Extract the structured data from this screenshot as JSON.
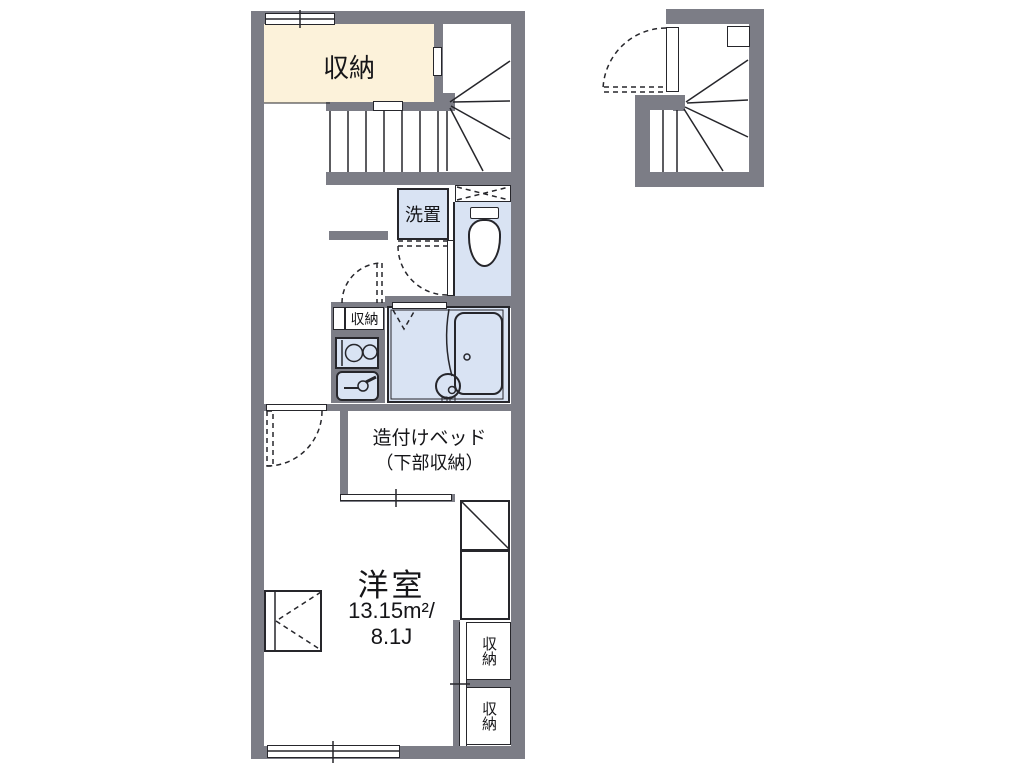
{
  "plan": {
    "labels": {
      "storage_top": "収納",
      "laundry": "洗置",
      "kitchen_storage": "収納",
      "bed_line1": "造付けベッド",
      "bed_line2": "（下部収納）",
      "room_name": "洋室",
      "room_area_m2": "13.15m²/",
      "room_area_jo": "8.1J",
      "storage_right_upper": "収納",
      "storage_right_lower": "収納"
    },
    "colors": {
      "wall": "#7c7d86",
      "storage_fill": "#fcf2da",
      "wet_area_fill": "#d9e3f3",
      "tub_fill": "#e7edf8",
      "line": "#26262b"
    }
  }
}
